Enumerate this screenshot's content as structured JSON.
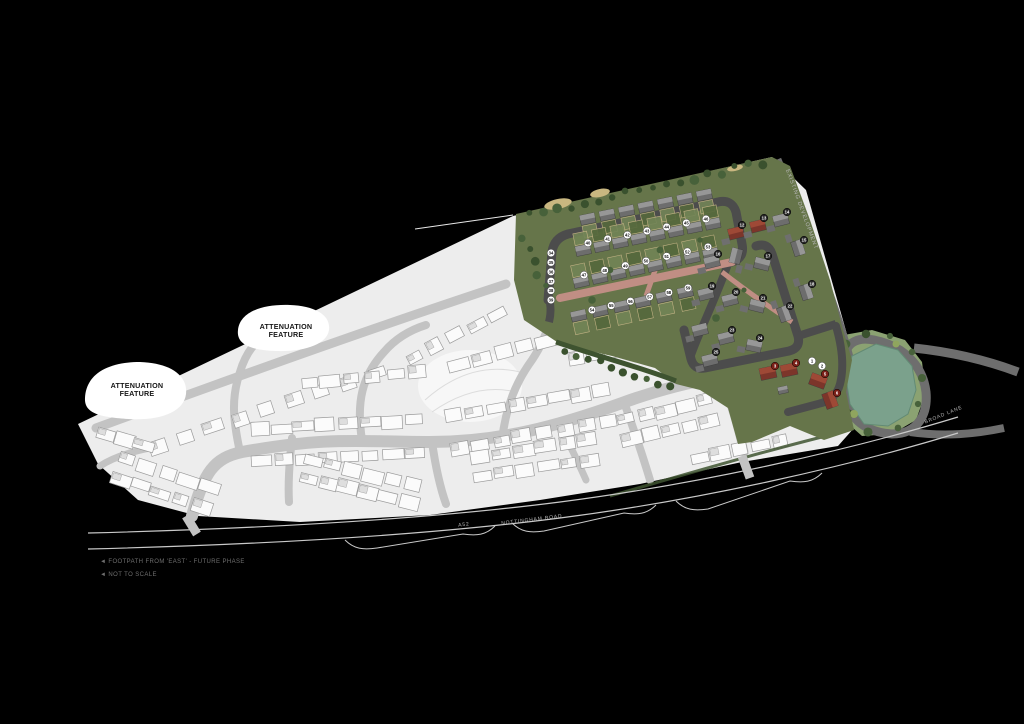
{
  "title": "Housing development site plan",
  "canvas": {
    "width": 1024,
    "height": 724,
    "background": "#000000"
  },
  "labels": {
    "attenuation_feature_1_line1": "ATTENUATION",
    "attenuation_feature_1_line2": "FEATURE",
    "attenuation_feature_2_line1": "ATTENUATION",
    "attenuation_feature_2_line2": "FEATURE"
  },
  "roads": {
    "a_road_ref": "A52",
    "a_road_name": "NOTTINGHAM ROAD",
    "boundary_road_label": "EXISTING DEVELOPMENT",
    "lane_label": "BROAD LANE"
  },
  "annotations": {
    "note_line1": "◄ FOOTPATH FROM 'EAST' - FUTURE PHASE",
    "note_line2": "◄ NOT TO SCALE"
  },
  "plots": {
    "entry_white_badges": [
      1,
      2
    ],
    "red_badge_start": 3,
    "red_badge_count": 4,
    "dark_badge_start": 12,
    "dark_badge_count": 14,
    "white_badge_start": 34,
    "white_badge_count": 26
  },
  "colors": {
    "background": "#000000",
    "site_grey": "#ededed",
    "open_space": "#f7f7f7",
    "road_grey": "#c3c3c3",
    "house_fill": "#fbfbfb",
    "house_stroke": "#9b9b9b",
    "house_detail": "#dedede",
    "attenuation_fill": "#ffffff",
    "parcel_green": "#66754a",
    "garden_green_a": "#55683c",
    "garden_green_b": "#728456",
    "tree_green": "#3a512e",
    "tree_green_b": "#47613a",
    "bush_light": "#8fa55e",
    "hedge_green": "#3e5330",
    "street_dark": "#4c4c4c",
    "boundary_road_grey": "#6e6e6e",
    "paving_pink": "#c08e84",
    "roof_grey": "#979797",
    "roof_grey_dark": "#6d6d6d",
    "roof_red": "#9e4936",
    "roof_red_dark": "#7c352a",
    "fence_tan": "#cbb88a",
    "sand": "#c9b780",
    "drive_grey": "#6f6f6f",
    "pond_water": "#7ba18c",
    "pond_edge": "#628a74",
    "pond_bank": "#8ba272",
    "road_line": "#c9c9c9",
    "badge_white": "#ffffff",
    "badge_dark": "#262626",
    "badge_red": "#7a2018",
    "badge_text_dark": "#111111",
    "badge_text_light": "#ffffff",
    "boundary_line_white": "#e8e8e8"
  }
}
